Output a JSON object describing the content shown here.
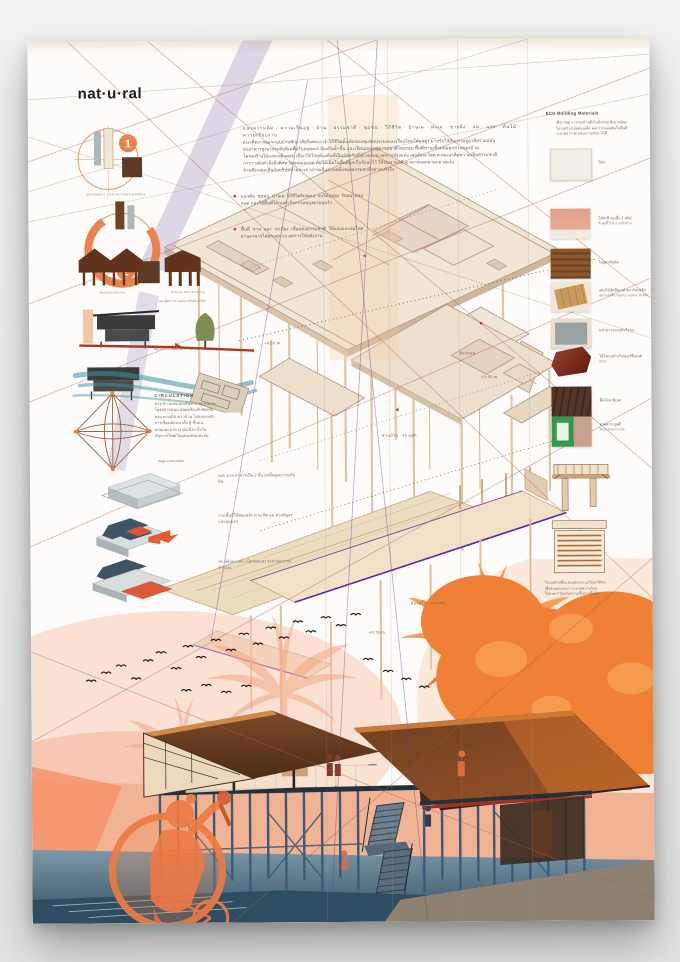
{
  "title": "nat·u·ral",
  "intro": {
    "lines": [
      "แนวความคิด · ความเป็นอยู่ · บ้าน · ธรรมชาติ · ชุมชน · วิถีชีวิต · บ้านเผ · ทะเล · ชายฝั่ง · ลม · แสง · ต้นไม้ · ความเรียบง่าย",
      "แนวคิดการออกแบบบ้านพักอาศัยริมทะเล นำวิถีชีวิตดั้งเดิมของชุมชนประมงและเรือนไทยใต้ถุนสูง มาปรับใช้กับการอยู่อาศัยร่วมสมัย",
      "ยกอาคารสูงจากระดับดินเพื่อรับลมทะเล ป้องกันน้ำขึ้น และเปิดมุมมองสู่ธรรมชาติโดยรอบ พื้นที่ชานเชื่อมต่อทุกส่วนของบ้าน",
      "โครงสร้างไม้และเหล็กผสม เลือกใช้วัสดุท้องถิ่นที่เป็นมิตรกับสิ่งแวดล้อม ลดการปรุงแต่ง เผยสัจจะวัสดุ ตามแนวคิดความเป็นธรรมชาติ",
      "การวางผังคำนึงถึงทิศทางแดดและลม ต้นไม้เดิมในพื้นที่ถูกเก็บรักษาไว้ ให้ร่มเงาแก่ตัวอาคารและชานกลางแจ้ง",
      "บ้านจึงกลมกลืนกับบริบทชายทะเล กลายเป็นส่วนหนึ่งของธรรมชาติอย่างแท้จริง"
    ]
  },
  "bullets": [
    {
      "text": "แนวคิด ชุมชน บ้านเผ วิถีชีวิตริมทะเล ยกใต้ถุนสูง รับลม หลบแดด และใช้พื้นที่ใต้ถุนทำกิจกรรมของครอบครัว"
    },
    {
      "text": "พื้นที่ ชาน และ ระเบียง เชื่อมต่อธรรมชาติ ให้แสงและลมไหลผ่านอาคารได้ทุกฤดูกาล ลดการใช้พลังงาน"
    }
  ],
  "left": {
    "d1_caption": "MOVEMENT  LIFE  PATTERN  BANPHE",
    "badge1": "1",
    "badge2": "2",
    "sil1": "Building  Outline",
    "sil2": "Natural  Stilt  Building",
    "section_caption": "แนวคิดการวางอาคารกับต้นไม้เดิม",
    "wind_caption": "ทิศ ทาง ลม ทะเล (SITE FLOW)",
    "circ_title": "CIRCULATION",
    "circ_lines": [
      "ทางเข้า ออกแบบเส้นทาง ชุมชนและ",
      "โครงข่ายถนน สอดคล้องกับทิศเดิม",
      "ของ ทางเดิน ชาวบ้าน โดยยกระดับ",
      "การเชื่อมต่อแนวตั้ง สู่ ชั้นบน",
      "ชานและอาคาร ต่อเนื่อง ถึงกัน",
      "เกิดการไหลเวียนของคนและลม"
    ],
    "stage_caption": "stage  Composition",
    "m1": "แยก มวล อาคารเป็น 2 ชั้น ยกพื้นสูงจากระดับดิน",
    "m2": "วาง พื้นที่ใช้สอยหลัก ตาม ทิศ ลม ทางสัญจร และมุมมอง",
    "m3": "ยก หลังคา และ เปิดช่องแสง ระบายอากาศ ด้านบน"
  },
  "axon_labels": {
    "l1": "+4.50 m.",
    "l2": "ชานบ้าน · 45 sqm.",
    "l3": "ห้องนอน",
    "l4": "+1.50 m.",
    "l5": "ห้องครัว · ชานหลัง",
    "l6": "+0.75 m."
  },
  "materials": {
    "header": "ECO Building Materials",
    "intro_lines": [
      "เลือกวัสดุ การก่อสร้างที่เป็นมิตรต่อ สิ่งแวดล้อม",
      "โครงสร้างไม้ผสมเหล็ก ลดการก่อมลพิษในพื้นที่",
      "ระบายอากาศ และความร้อน ได้ดี"
    ],
    "items": [
      {
        "label": "ไม้ฝา"
      },
      {
        "label": "ไม้ฝาสี รองพื้น T-ABC",
        "sub": "สี พุตตี้โอ๊ค แบบผิวด้าน"
      },
      {
        "label": "ไม้ยูคาลิปตัส"
      },
      {
        "label": "แผ่นไม้อัดซีเมนต์ สมาร์ทบอร์ด",
        "sub": "ชุดโครงพื้น รอยต่อ Joyest Timber"
      },
      {
        "label": "หน้าต่างวงกบสำเร็จรูป"
      },
      {
        "label": "ไม้โครงสร้างไฟเบอร์ซีเมนต์",
        "sub": "SCG"
      },
      {
        "label": "พื้นไม้ลามิเนต"
      },
      {
        "label": "ลวดลาย ปูนสี",
        "sub": "Gray Stain Code"
      }
    ],
    "detail_lines": [
      "โครงสร้างพื้นและผนังระแนงไม้ยกใต้ถุน",
      "เพื่อรับลมและเงา ระบายความร้อน",
      "ใต้อาคารป้องกันความชื้นจากพื้นดิน"
    ]
  },
  "colors": {
    "accent_orange": "#e8834e",
    "roof_brown": "#7c4a28",
    "steel_blue": "#3e627b",
    "purple_accent": "#5a2a9a",
    "construction_line": "#b36a6a",
    "teal_flow": "#3f8fa0"
  }
}
